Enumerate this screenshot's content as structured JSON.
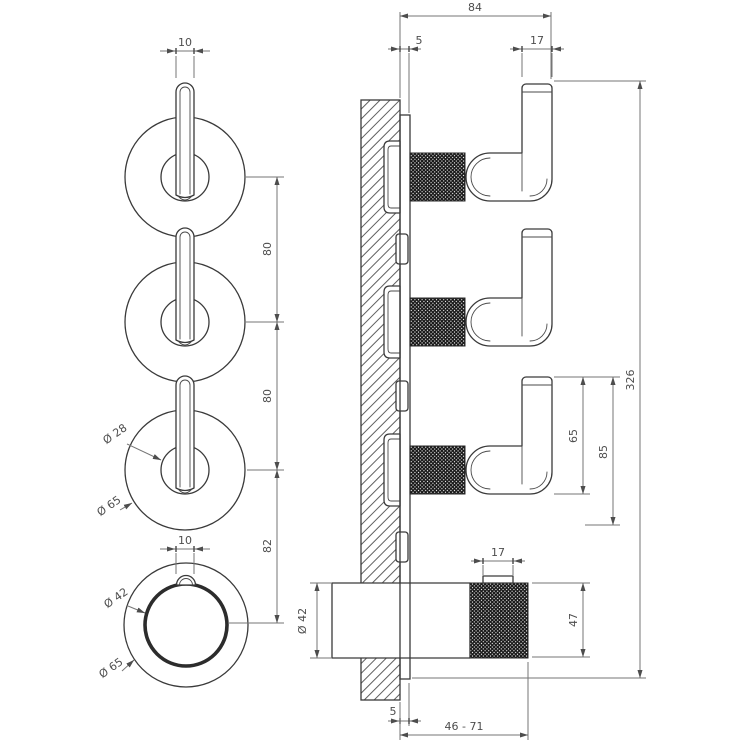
{
  "drawing": {
    "title": "mixer-technical-drawing",
    "style": {
      "object_line_color": "#3a3a3a",
      "dimension_line_color": "#767676",
      "text_color": "#4d4d4d",
      "background": "#ffffff"
    },
    "front_view": {
      "lever_width": "10",
      "pitch_top": "80",
      "pitch_mid": "80",
      "pitch_bottom": "82",
      "handle_inner_dia": "Ø 28",
      "trim_dia": "Ø 65",
      "knob_tab_width": "10",
      "knob_grip_dia": "Ø 42",
      "knob_trim_dia": "Ø 65"
    },
    "side_view": {
      "total_depth": "84",
      "plate_thickness_top": "5",
      "lever_bar_width": "17",
      "total_height": "326",
      "lever_height": "65",
      "lever_span": "85",
      "knob_tab_width": "17",
      "knob_height": "47",
      "body_dia": "Ø 42",
      "plate_thickness_bottom": "5",
      "rough_in_range": "46 - 71"
    }
  }
}
